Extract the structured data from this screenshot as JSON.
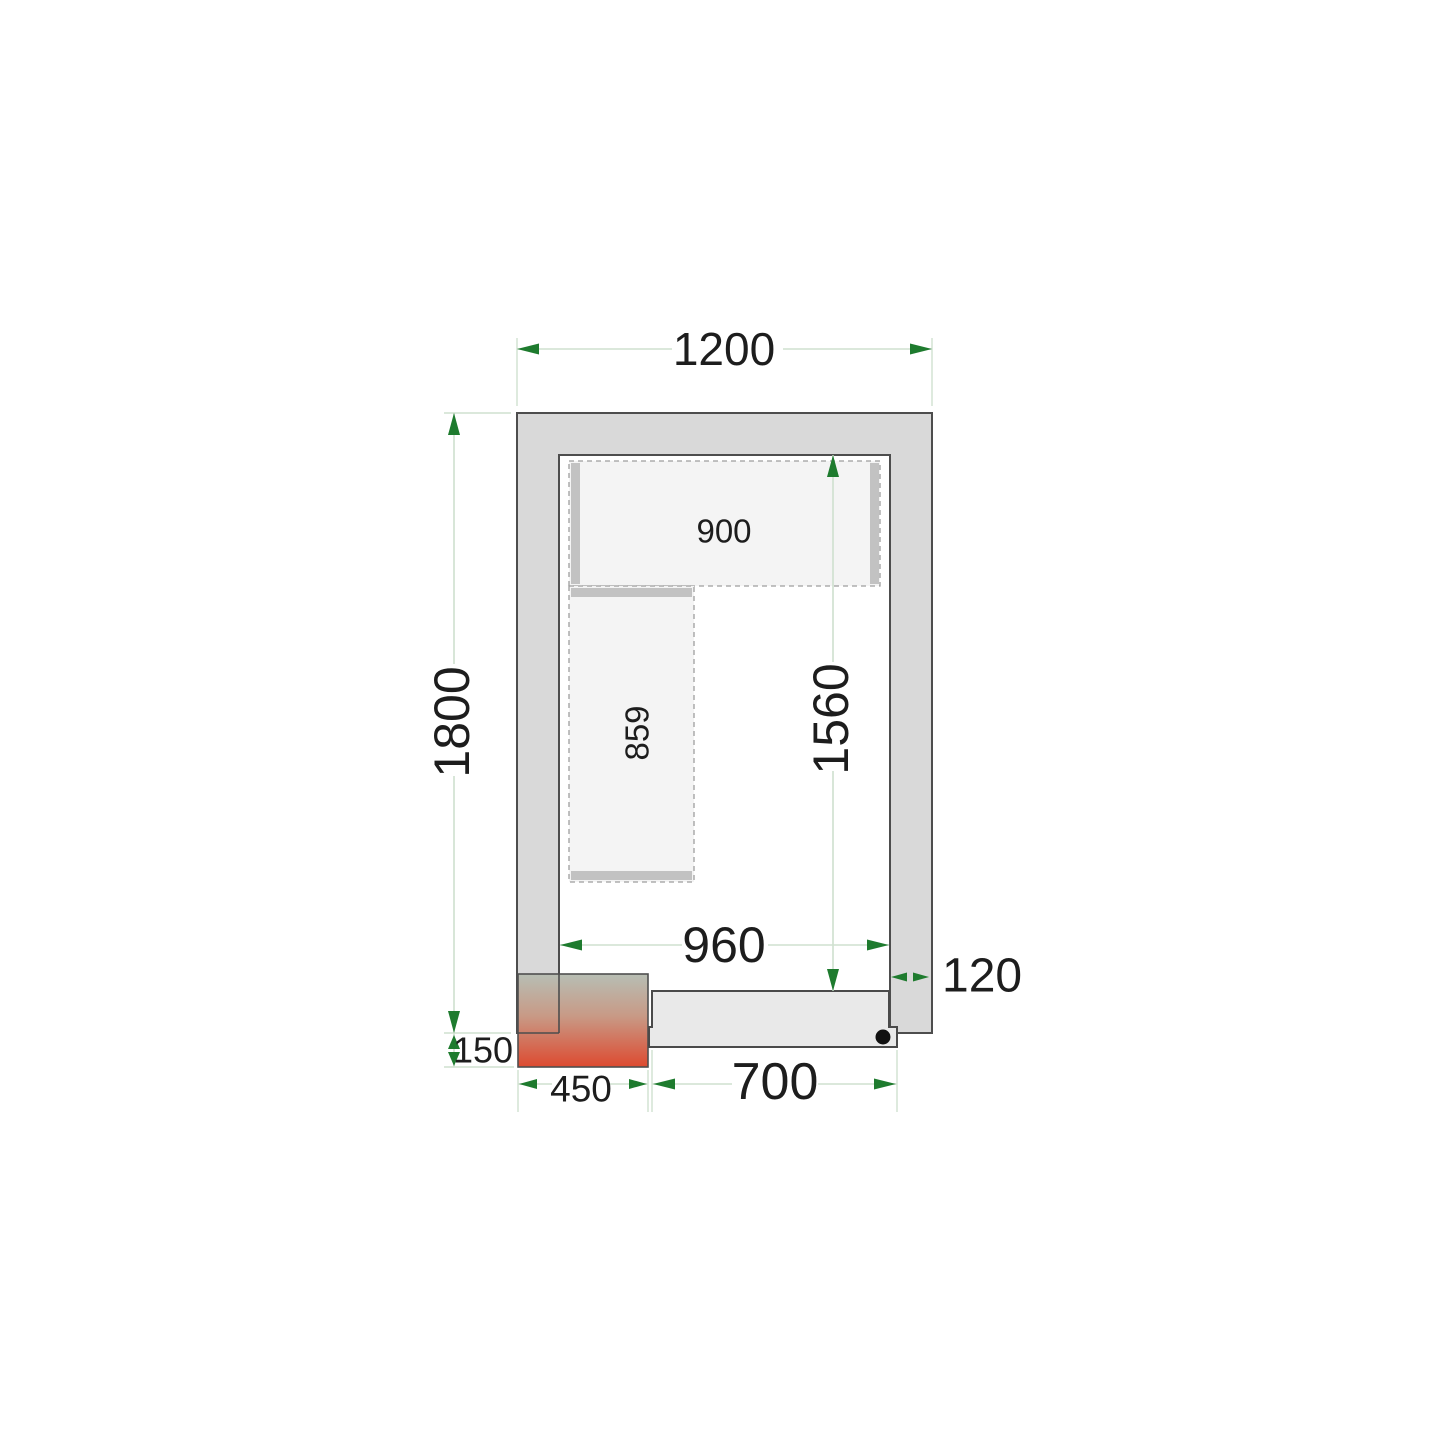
{
  "diagram": {
    "name": "cold-room-floor-plan",
    "dimension_labels": {
      "outer_width": "1200",
      "outer_depth": "1800",
      "inner_width": "960",
      "inner_depth": "1560",
      "wall_thickness": "120",
      "door_opening_width": "700",
      "unit_block_width": "450",
      "unit_block_overhang": "150",
      "top_shelf_length": "900",
      "left_shelf_length": "859"
    },
    "colors": {
      "wall_fill": "#d9d9d9",
      "outline": "#4d4d4d",
      "floor": "#ffffff",
      "shelf_fill": "#f4f4f4",
      "shelf_dash_border": "#9e9e9e",
      "shelf_support": "#c2c2c2",
      "door_fill": "#e9e9e9",
      "dimension_line": "#cfe0cf",
      "dimension_arrow": "#1e7b2e",
      "unit_gradient_top": "#b7beb4",
      "unit_gradient_bottom": "#dd4a30",
      "text": "#1d1d1d",
      "hinge_dot": "#111111"
    }
  }
}
